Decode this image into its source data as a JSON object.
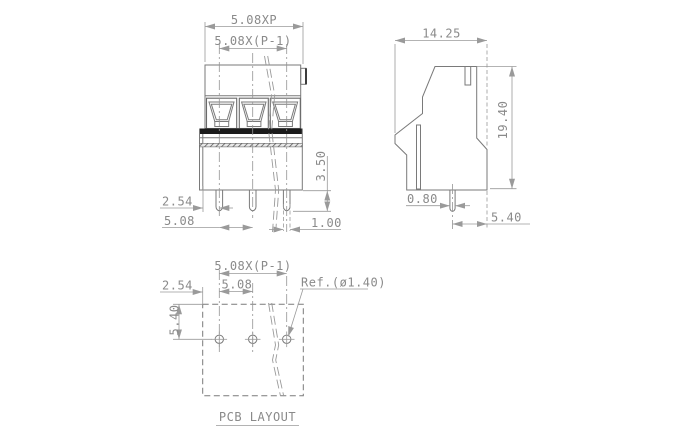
{
  "drawing": {
    "type": "terminal-block dimensional drawing",
    "caption": "PCB LAYOUT"
  },
  "colors": {
    "background": "#ffffff",
    "line": "#7a7a7a",
    "dimension": "#9a9a9a",
    "text": "#8a8a8a",
    "dark_band": "#1b1b1b"
  },
  "front_view": {
    "dims": {
      "pitch_total": "5.08XP",
      "pitch_span": "5.08X(P-1)",
      "pin_length": "3.50",
      "edge_to_pin": "2.54",
      "pin_pitch": "5.08",
      "pin_width": "1.00"
    }
  },
  "side_view": {
    "dims": {
      "depth": "14.25",
      "height": "19.40",
      "pin_width": "0.80",
      "pin_to_back": "5.40"
    }
  },
  "pcb_layout": {
    "caption": "PCB LAYOUT",
    "dims": {
      "pitch_span": "5.08X(P-1)",
      "edge_to_hole": "2.54",
      "hole_pitch": "5.08",
      "edge_offset": "5.40",
      "hole_ref": "Ref.(ø1.40)"
    }
  }
}
